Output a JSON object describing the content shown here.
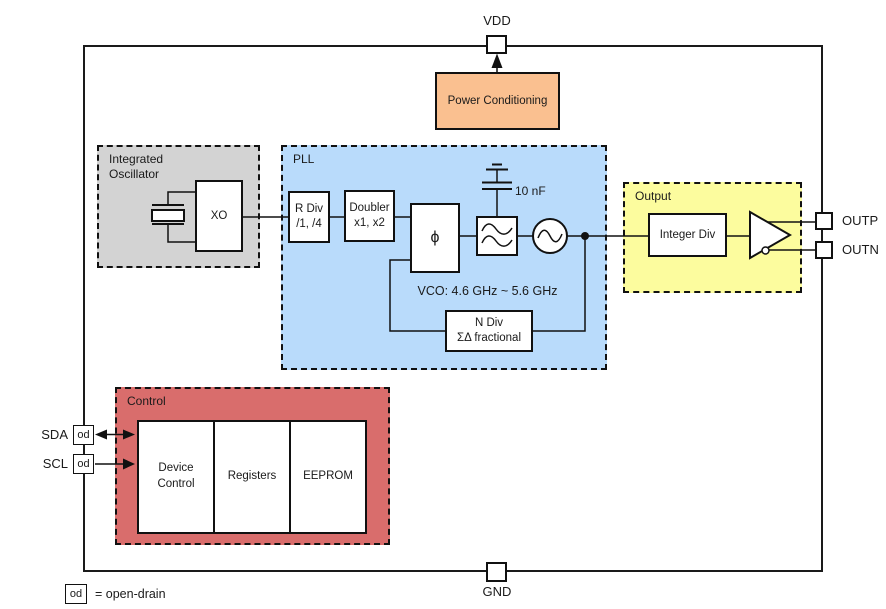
{
  "diagram": {
    "pins": {
      "vdd": "VDD",
      "gnd": "GND",
      "outp": "OUTP",
      "outn": "OUTN",
      "sda": "SDA",
      "scl": "SCL",
      "od": "od"
    },
    "legend": {
      "od": "od",
      "text": "= open-drain"
    },
    "power": {
      "label": "Power Conditioning"
    },
    "oscillator": {
      "title": "Integrated Oscillator",
      "xo": "XO"
    },
    "pll": {
      "title": "PLL",
      "rdiv_line1": "R Div",
      "rdiv_line2": "/1, /4",
      "doubler_line1": "Doubler",
      "doubler_line2": "x1, x2",
      "phase_detector": "ϕ",
      "cap_label": "10 nF",
      "vco_label": "VCO: 4.6 GHz ~ 5.6 GHz",
      "ndiv_line1": "N Div",
      "ndiv_line2": "ΣΔ fractional"
    },
    "output": {
      "title": "Output",
      "integer_div": "Integer Div"
    },
    "control": {
      "title": "Control",
      "blocks": [
        "Device Control",
        "Registers",
        "EEPROM"
      ]
    },
    "colors": {
      "power": "#FAC090",
      "oscillator": "#D3D3D3",
      "pll": "#B9DBFB",
      "output": "#FCFC9E",
      "control": "#D96D6C"
    }
  }
}
